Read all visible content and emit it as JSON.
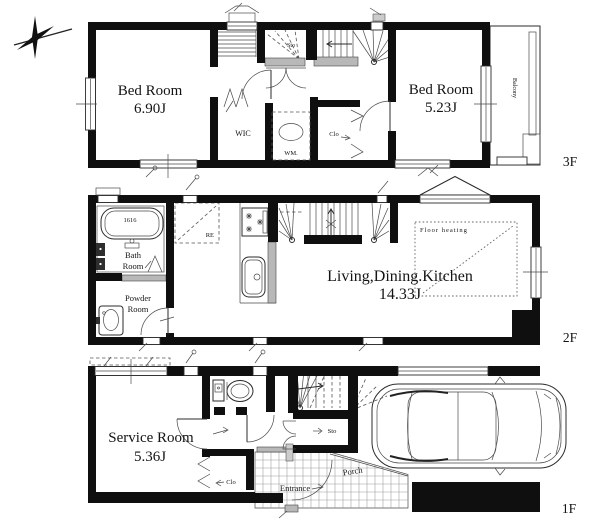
{
  "floor3": {
    "label": "3F",
    "bedroom_left": {
      "name": "Bed Room",
      "size": "6.90J"
    },
    "bedroom_right": {
      "name": "Bed Room",
      "size": "5.23J"
    },
    "wic": "WIC",
    "washing_machine": "WM.",
    "closet": "Clo",
    "storage": "Sto",
    "balcony": "Balcony"
  },
  "floor2": {
    "label": "2F",
    "ldk": {
      "name": "Living,Dining.Kitchen",
      "size": "14.33J"
    },
    "bath_room": {
      "line1": "Bath",
      "line2": "Room"
    },
    "bathtub_size": "1616",
    "powder_room": {
      "line1": "Powder",
      "line2": "Room"
    },
    "refrigerator": "RE",
    "floor_heating": "Floor heating"
  },
  "floor1": {
    "label": "1F",
    "service_room": {
      "name": "Service Room",
      "size": "5.36J"
    },
    "closet": "Clo",
    "storage": "Sto",
    "entrance": "Entrance",
    "porch": "Porch"
  }
}
